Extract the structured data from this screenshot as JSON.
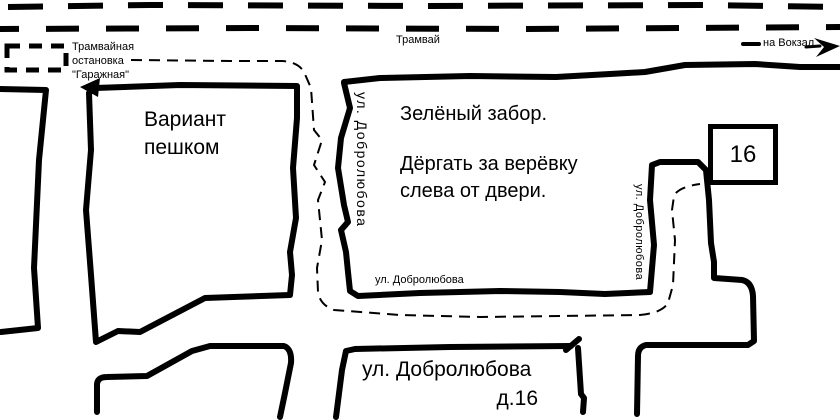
{
  "colors": {
    "ink": "#000000",
    "background": "#ffffff"
  },
  "tram": {
    "line_label": "Трамвай",
    "to_station_label": "на Вокзал",
    "to_station_arrow_icon": "right-arrow"
  },
  "tram_stop": {
    "line1": "Трамвайная",
    "line2": "остановка",
    "line3": "\"Гаражная\""
  },
  "walk": {
    "option_label": "Вариант\nпешком",
    "route_style": "dashed",
    "arrow_icon": "left-arrow"
  },
  "notes": {
    "fence": "Зелёный забор.",
    "door": "Дёргать за верёвку\nслева от двери."
  },
  "house": {
    "number": "16"
  },
  "streets": {
    "left_vertical": "ул. Добролюбова",
    "right_vertical": "ул. Добролюбова",
    "along_block": "ул. Добролюбова",
    "destination_street": "ул. Добролюбова",
    "destination_house": "д.16"
  }
}
